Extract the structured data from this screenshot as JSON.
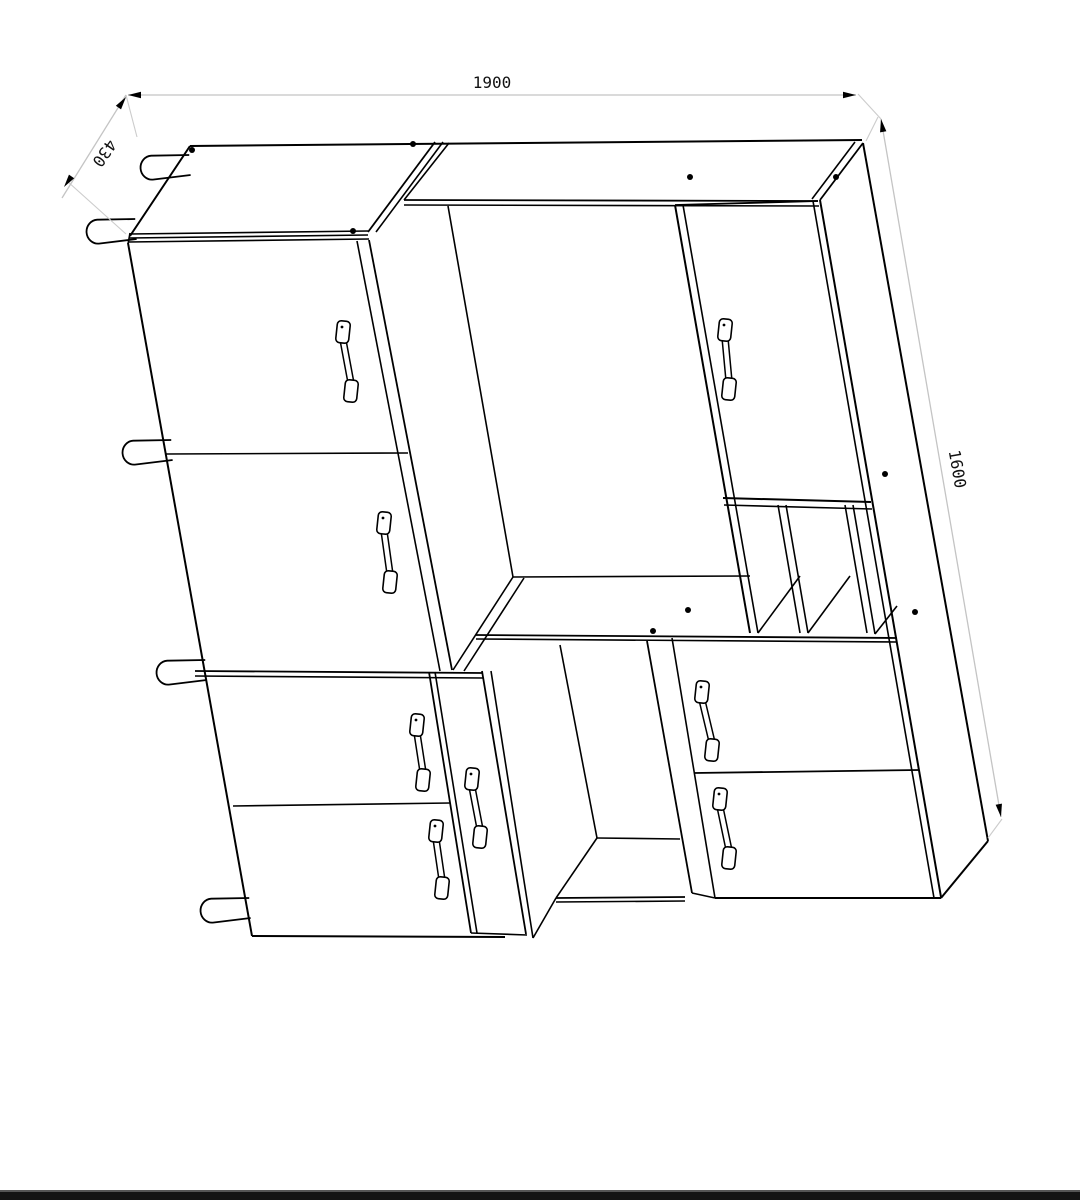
{
  "drawing": {
    "kind": "furniture-cabinet-technical-drawing",
    "canvas": {
      "width": 1080,
      "height": 1200,
      "background": "#ffffff"
    },
    "colors": {
      "line": "#000000",
      "dim_line": "#c4c4c4",
      "ext_line": "#cccccc",
      "arrow": "#000000",
      "text": "#111111",
      "bottom_bar": "#141414",
      "bottom_bar_edge": "#555555"
    },
    "dimensions": [
      {
        "id": "width-1900",
        "label": "1900",
        "line": [
          128,
          95,
          856,
          95
        ],
        "label_pos": [
          492,
          88
        ],
        "label_rotation": 0,
        "arrows": [
          {
            "tip": [
              128,
              95
            ],
            "dir": [
              -1,
              0
            ]
          },
          {
            "tip": [
              856,
              95
            ],
            "dir": [
              1,
              0
            ]
          }
        ]
      },
      {
        "id": "depth-430",
        "label": "430",
        "line": [
          126,
          95,
          62,
          198
        ],
        "label_pos": [
          100,
          150
        ],
        "label_rotation": 125,
        "arrows": [
          {
            "tip": [
              126,
              97
            ],
            "dir": [
              0.58,
              -0.81
            ]
          },
          {
            "tip": [
              64,
              187
            ],
            "dir": [
              -0.58,
              0.81
            ]
          }
        ]
      },
      {
        "id": "height-1600",
        "label": "1600",
        "line": [
          881,
          119,
          1001,
          817
        ],
        "label_pos": [
          952,
          470
        ],
        "label_rotation": 80,
        "arrows": [
          {
            "tip": [
              881,
              119
            ],
            "dir": [
              -0.17,
              -0.985
            ]
          },
          {
            "tip": [
              1001,
              817
            ],
            "dir": [
              0.17,
              0.985
            ]
          }
        ]
      }
    ],
    "extension_lines": [
      [
        126,
        95,
        137,
        137
      ],
      [
        126,
        234,
        67,
        181
      ],
      [
        858,
        94,
        881,
        119
      ],
      [
        866,
        141,
        878,
        117
      ],
      [
        988,
        838,
        1002,
        819
      ]
    ],
    "lines": [
      [
        190,
        146,
        862,
        140,
        2
      ],
      [
        190,
        146,
        130,
        236,
        2
      ],
      [
        130,
        234,
        368,
        231,
        1.6
      ],
      [
        129,
        238,
        368,
        235,
        1.6
      ],
      [
        128,
        242,
        369,
        239,
        1.6
      ],
      [
        130,
        233,
        128,
        244,
        1.6
      ],
      [
        435,
        142,
        368,
        232,
        1.8
      ],
      [
        443,
        142,
        376,
        232,
        1.6
      ],
      [
        449,
        143,
        404,
        200,
        1.6
      ],
      [
        404,
        200,
        818,
        201,
        1.8
      ],
      [
        404,
        205,
        819,
        206,
        1.6
      ],
      [
        863,
        143,
        820,
        200,
        1.8
      ],
      [
        855,
        142,
        812,
        199,
        1.6
      ],
      [
        128,
        243,
        252,
        936,
        2
      ],
      [
        252,
        936,
        505,
        937,
        2
      ],
      [
        820,
        200,
        941,
        897,
        2
      ],
      [
        715,
        898,
        941,
        898,
        2
      ],
      [
        692,
        893,
        715,
        898,
        1.6
      ],
      [
        941,
        898,
        988,
        841,
        2
      ],
      [
        863,
        143,
        988,
        841,
        2
      ],
      [
        813,
        201,
        934,
        898,
        1.6
      ],
      [
        166,
        454,
        408,
        453,
        1.6
      ],
      [
        369,
        240,
        452,
        670,
        1.8
      ],
      [
        357,
        241,
        440,
        671,
        1.6
      ],
      [
        195,
        671,
        483,
        673,
        1.8
      ],
      [
        195,
        676,
        483,
        678,
        1.6
      ],
      [
        429,
        672,
        471,
        933,
        1.8
      ],
      [
        435,
        672,
        477,
        933,
        1.6
      ],
      [
        233,
        806,
        450,
        803,
        1.6
      ],
      [
        482,
        671,
        526,
        934,
        1.8
      ],
      [
        491,
        671,
        533,
        938,
        1.6
      ],
      [
        533,
        938,
        556,
        898,
        1.6
      ],
      [
        471,
        933,
        527,
        935,
        1.6
      ],
      [
        448,
        206,
        513,
        577,
        1.6
      ],
      [
        513,
        577,
        750,
        576,
        1.6
      ],
      [
        513,
        577,
        453,
        670,
        1.6
      ],
      [
        524,
        578,
        464,
        671,
        1.6
      ],
      [
        476,
        635,
        897,
        638,
        1.8
      ],
      [
        476,
        639,
        897,
        642,
        1.6
      ],
      [
        675,
        205,
        750,
        633,
        2
      ],
      [
        683,
        205,
        758,
        633,
        1.6
      ],
      [
        675,
        205,
        818,
        201,
        1.8
      ],
      [
        723,
        498,
        871,
        502,
        2
      ],
      [
        724,
        505,
        872,
        509,
        1.6
      ],
      [
        560,
        645,
        597,
        838,
        1.6
      ],
      [
        597,
        838,
        556,
        898,
        1.6
      ],
      [
        556,
        898,
        685,
        897,
        1.8
      ],
      [
        556,
        902,
        685,
        901,
        1.6
      ],
      [
        597,
        838,
        680,
        839,
        1.6
      ],
      [
        647,
        641,
        692,
        893,
        1.8
      ],
      [
        672,
        638,
        715,
        898,
        1.6
      ],
      [
        778,
        505,
        800,
        633,
        1.6
      ],
      [
        786,
        505,
        808,
        633,
        1.6
      ],
      [
        845,
        505,
        867,
        633,
        1.6
      ],
      [
        853,
        505,
        875,
        634,
        1.6
      ],
      [
        758,
        633,
        800,
        576,
        1.6
      ],
      [
        808,
        633,
        850,
        576,
        1.6
      ],
      [
        875,
        634,
        897,
        606,
        1.6
      ],
      [
        694,
        773,
        919,
        770,
        1.8
      ]
    ],
    "dots": [
      [
        192,
        150
      ],
      [
        413,
        144
      ],
      [
        690,
        177
      ],
      [
        836,
        177
      ],
      [
        353,
        231
      ],
      [
        885,
        474
      ],
      [
        915,
        612
      ],
      [
        688,
        610
      ],
      [
        653,
        631
      ]
    ],
    "handles": [
      {
        "name": "handle-left-upper-door-1",
        "top": [
          343,
          332
        ],
        "bottom": [
          351,
          391
        ]
      },
      {
        "name": "handle-left-upper-door-2",
        "top": [
          384,
          523
        ],
        "bottom": [
          390,
          582
        ]
      },
      {
        "name": "handle-right-top-door",
        "top": [
          725,
          330
        ],
        "bottom": [
          729,
          389
        ]
      },
      {
        "name": "handle-left-lower-door-1",
        "top": [
          417,
          725
        ],
        "bottom": [
          423,
          780
        ]
      },
      {
        "name": "handle-left-lower-door-2",
        "top": [
          436,
          831
        ],
        "bottom": [
          442,
          888
        ]
      },
      {
        "name": "handle-narrow-drawer",
        "top": [
          472,
          779
        ],
        "bottom": [
          480,
          837
        ]
      },
      {
        "name": "handle-right-lower-drawer-1",
        "top": [
          702,
          692
        ],
        "bottom": [
          712,
          750
        ]
      },
      {
        "name": "handle-right-lower-drawer-2",
        "top": [
          720,
          799
        ],
        "bottom": [
          729,
          858
        ]
      }
    ],
    "pegs": [
      {
        "attach": [
          190,
          166
        ]
      },
      {
        "attach": [
          136,
          230
        ]
      },
      {
        "attach": [
          172,
          451
        ]
      },
      {
        "attach": [
          206,
          671
        ]
      },
      {
        "attach": [
          250,
          909
        ]
      }
    ],
    "bottom_bar": {
      "y": 1192,
      "height": 8
    }
  }
}
